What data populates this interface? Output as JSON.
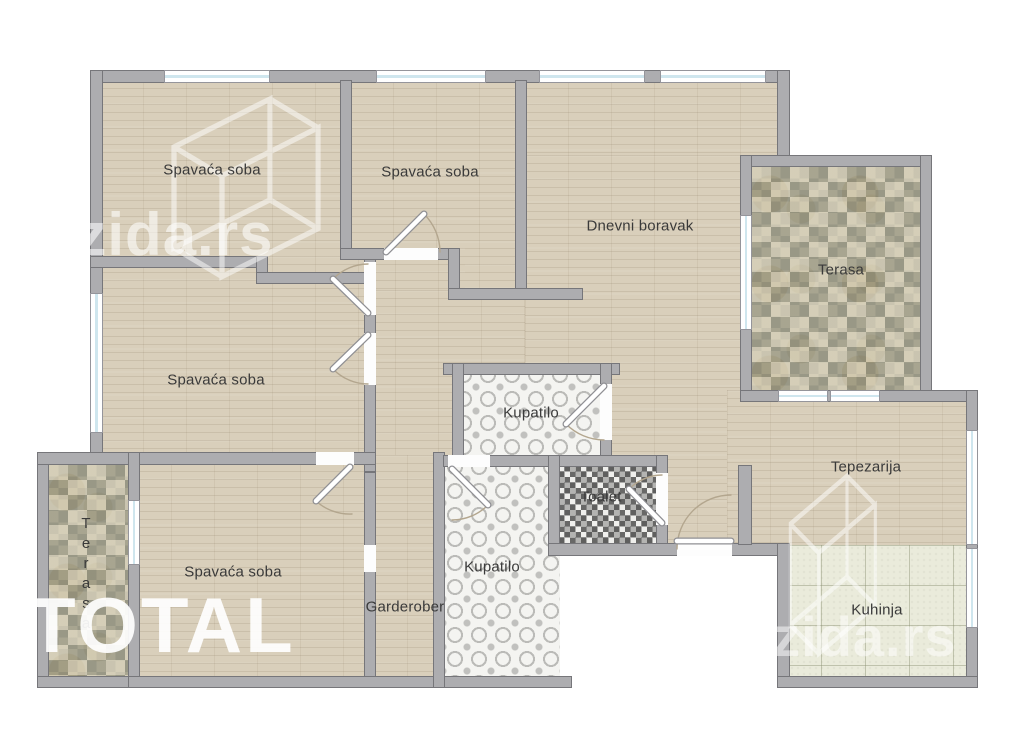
{
  "plan": {
    "title": "Apartment floor plan",
    "rooms": [
      {
        "id": "bedroom-1",
        "label": "Spavaća soba",
        "floor": "wood"
      },
      {
        "id": "bedroom-2",
        "label": "Spavaća soba",
        "floor": "wood"
      },
      {
        "id": "living-room",
        "label": "Dnevni boravak",
        "floor": "wood"
      },
      {
        "id": "terrace-top-right",
        "label": "Terasa",
        "floor": "stone"
      },
      {
        "id": "bedroom-3",
        "label": "Spavaća soba",
        "floor": "wood"
      },
      {
        "id": "bathroom-1",
        "label": "Kupatilo",
        "floor": "ornate-tile"
      },
      {
        "id": "dining-room",
        "label": "Tepezarija",
        "floor": "wood"
      },
      {
        "id": "toilet",
        "label": "Toalet",
        "floor": "mosaic-tile"
      },
      {
        "id": "bathroom-2",
        "label": "Kupatilo",
        "floor": "ornate-tile"
      },
      {
        "id": "bedroom-4",
        "label": "Spavaća soba",
        "floor": "wood"
      },
      {
        "id": "wardrobe",
        "label": "Garderober",
        "floor": "wood"
      },
      {
        "id": "kitchen",
        "label": "Kuhinja",
        "floor": "ceramic-tile"
      },
      {
        "id": "terrace-left",
        "label": "Terasa",
        "floor": "stone"
      }
    ],
    "watermarks": {
      "brand_top_left": "4zida.rs",
      "brand_bottom_right": "4zida.rs",
      "agency": "TOTAL"
    },
    "colors": {
      "wall": "#adadb0",
      "wood_floor": "#d9cfbb",
      "stone_floor": "#c8c1ac",
      "ornate_tile": "#f4f4f1",
      "mosaic_tile": "#8d8d8b",
      "kitchen_tile": "#eaebdb",
      "window": "#cfe6ee",
      "label_text": "#3a3a3a"
    }
  }
}
